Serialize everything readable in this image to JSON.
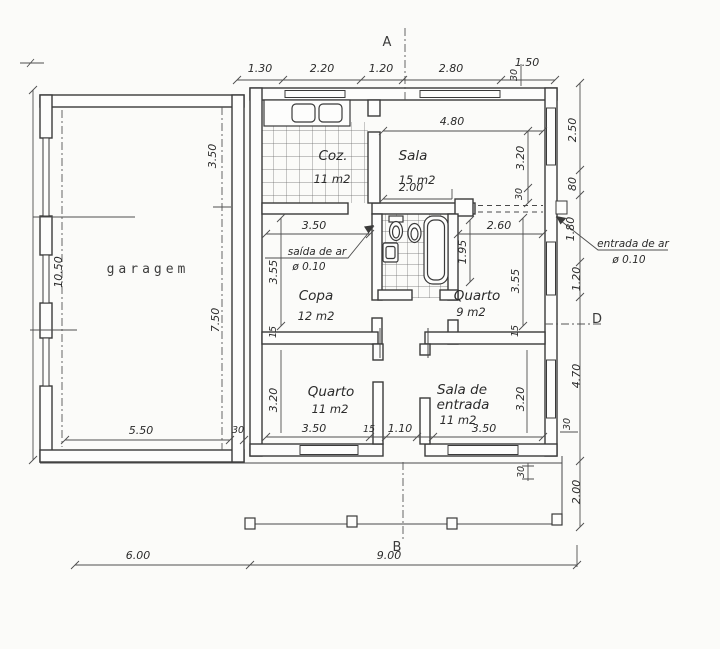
{
  "document": {
    "type": "architectural floor plan",
    "units": "m"
  },
  "markers": {
    "a": "A",
    "b": "B",
    "d": "D"
  },
  "rooms": {
    "garagem": {
      "name": "garagem"
    },
    "cozinha": {
      "name": "Coz.",
      "area": "11 m2"
    },
    "sala": {
      "name": "Sala",
      "area": "15 m2"
    },
    "copa": {
      "name": "Copa",
      "area": "12 m2"
    },
    "quarto9": {
      "name": "Quarto",
      "area": "9 m2"
    },
    "quarto11": {
      "name": "Quarto",
      "area": "11 m2"
    },
    "sala_entrada": {
      "name_line1": "Sala de",
      "name_line2": "entrada",
      "area": "11 m2"
    }
  },
  "annotations": {
    "saida_ar": {
      "line1": "saída de ar",
      "line2": "ø 0.10"
    },
    "entrada_ar": {
      "line1": "entrada de ar",
      "line2": "ø 0.10"
    }
  },
  "dims": {
    "top": {
      "d1": "1.30",
      "d2": "2.20",
      "d3": "1.20",
      "d4": "2.80",
      "d5": "1.50",
      "d6": "30"
    },
    "right": {
      "d1": "2.50",
      "d2": "80",
      "d3": "1.80",
      "d4": "1.20",
      "d5": "4.70",
      "d6": "30",
      "d7": "2.00"
    },
    "bottom": {
      "d1": "6.00",
      "d2": "9.00"
    },
    "left": {
      "d1": "10.50"
    },
    "garage": {
      "d1": "3.50",
      "d2": "7.50",
      "d3": "5.50",
      "d4": "30"
    },
    "sala": {
      "d1": "4.80",
      "d2": "3.20",
      "d3": "30",
      "d4": "2.00"
    },
    "copa": {
      "d1": "3.50",
      "d2": "3.55",
      "d3": "15"
    },
    "quarto9": {
      "d1": "2.60",
      "d2": "3.55",
      "d3": "15",
      "d4": "1.95"
    },
    "bottom_row": {
      "d1": "3.20",
      "d2": "3.50",
      "d3": "15",
      "d4": "1.10",
      "d5": "3.50",
      "d6": "3.20"
    },
    "porch": {
      "d1": "30"
    }
  }
}
